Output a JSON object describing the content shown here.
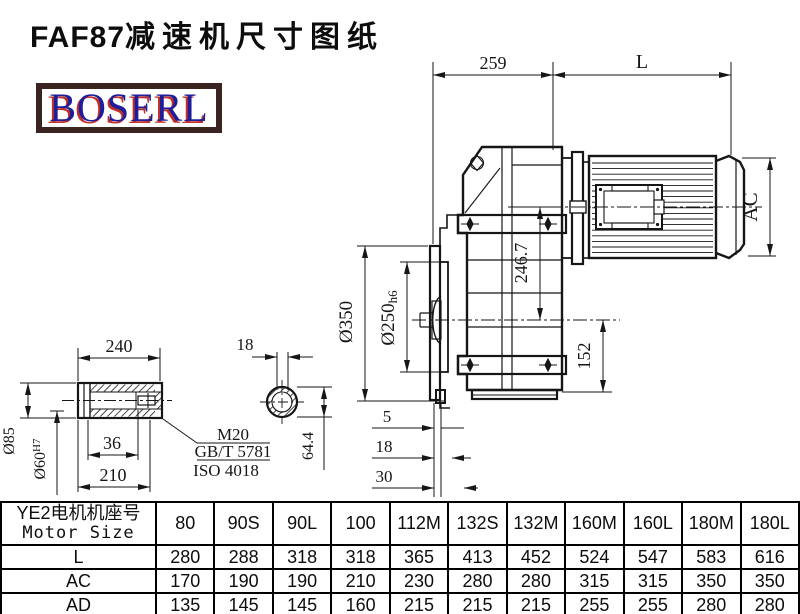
{
  "title": {
    "model": "FAF87",
    "text": "减速机尺寸图纸"
  },
  "logo": {
    "text": "BOSERL"
  },
  "drawing": {
    "dims": {
      "top_left": "259",
      "top_right": "L",
      "motor_height": "AC",
      "center_height": "246.7",
      "flange_od": "Ø350",
      "spigot": "Ø250",
      "spigot_tol": "h6",
      "axis_height": "152",
      "step1": "5",
      "step2": "18",
      "step3": "30",
      "shaft_len": "240",
      "bore_step": "36",
      "sleeve_len": "210",
      "shaft_od": "Ø85",
      "bore": "Ø60",
      "bore_tol": "H7",
      "slot_width": "18",
      "slot_height": "64.4",
      "bolt": "M20",
      "std1": "GB/T 5781",
      "std2": "ISO 4018"
    }
  },
  "table": {
    "header_cn": "YE2电机机座号",
    "header_en": "Motor Size",
    "columns": [
      "80",
      "90S",
      "90L",
      "100",
      "112M",
      "132S",
      "132M",
      "160M",
      "160L",
      "180M",
      "180L"
    ],
    "rows": [
      {
        "label": "L",
        "values": [
          "280",
          "288",
          "318",
          "318",
          "365",
          "413",
          "452",
          "524",
          "547",
          "583",
          "616"
        ]
      },
      {
        "label": "AC",
        "values": [
          "170",
          "190",
          "190",
          "210",
          "230",
          "280",
          "280",
          "315",
          "315",
          "350",
          "350"
        ]
      },
      {
        "label": "AD",
        "values": [
          "135",
          "145",
          "145",
          "160",
          "215",
          "215",
          "215",
          "255",
          "255",
          "280",
          "280"
        ]
      }
    ]
  }
}
